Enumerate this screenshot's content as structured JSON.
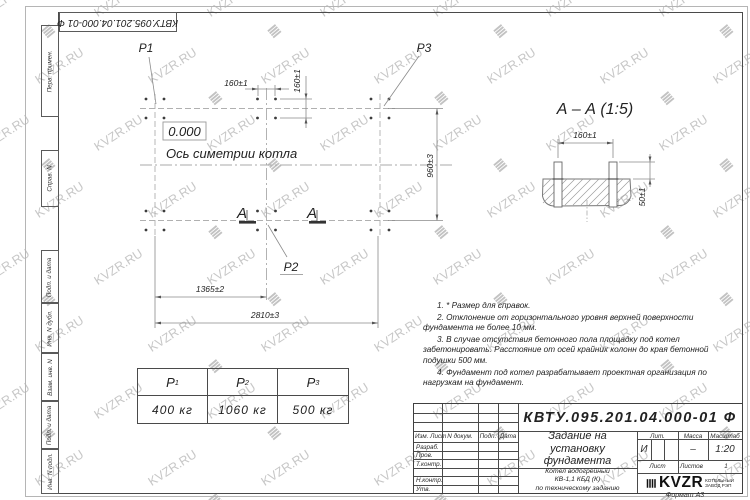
{
  "sheet": {
    "stamp": "КВТУ.095.201.04.000-01  Ф",
    "format_label": "Формат А3"
  },
  "watermark": {
    "text": "KVZR.RU"
  },
  "icons": {
    "brand_mark": "≣"
  },
  "sidebar": {
    "labels": [
      "Перв. примен.",
      "Справ. N",
      "Подп. и дата",
      "Инв. N дубл.",
      "Взам. инв. N",
      "Подп. и дата",
      "Инв. N подл."
    ]
  },
  "plan": {
    "labels": {
      "p1": "P1",
      "p2": "P2",
      "p3": "P3"
    },
    "elevation": "0.000",
    "axis_label": "Ось симетрии котла",
    "section_letter": "А",
    "dims": {
      "pitch_x": "160±1",
      "pitch_y": "160±1",
      "width": "960±3",
      "offset": "1365±2",
      "length": "2810±3"
    }
  },
  "section_view": {
    "title": "А – А (1:5)",
    "dims": {
      "pitch": "160±1",
      "height": "50±1"
    }
  },
  "notes": [
    "1. * Размер для справок.",
    "2. Отклонение от горизонтального уровня верхней поверхности фундамента не более 10 мм.",
    "3. В случае отсутствия бетонного пола площадку под котел забетонировать. Расстояние от осей крайних колонн до края бетонной подушки 500 мм.",
    "4. Фундамент под котел разрабатывает проектная организация по нагрузкам на фундамент."
  ],
  "load_table": {
    "headers": [
      {
        "base": "P",
        "sub": "1"
      },
      {
        "base": "P",
        "sub": "2"
      },
      {
        "base": "P",
        "sub": "3"
      }
    ],
    "values": [
      "400 кг",
      "1060 кг",
      "500 кг"
    ]
  },
  "title_block": {
    "doc_number": "КВТУ.095.201.04.000-01 Ф",
    "title_lines": [
      "Задание на",
      "установку",
      "фундамента"
    ],
    "subtitle_lines": [
      "Котел водогрейный",
      "КВ-1,1 КБД (К)",
      "по техническому заданию"
    ],
    "rev_headers": [
      "Изм. Лист",
      "N докум.",
      "Подп.",
      "Дата"
    ],
    "role_rows": [
      "Разраб.",
      "Пров.",
      "Т.контр.",
      "",
      "Н.контр.",
      "Утв."
    ],
    "lit_header": "Лит.",
    "mass_header": "Масса",
    "scale_header": "Масштаб",
    "lit_value": "И",
    "mass_value": "–",
    "scale_value": "1:20",
    "sheet_label": "Лист",
    "sheets_label": "Листов",
    "sheets_value": "1",
    "brand": "KVZR",
    "brand_lines": [
      "КОТЕЛЬНЫЙ",
      "ЗАВОД РЭП"
    ]
  }
}
